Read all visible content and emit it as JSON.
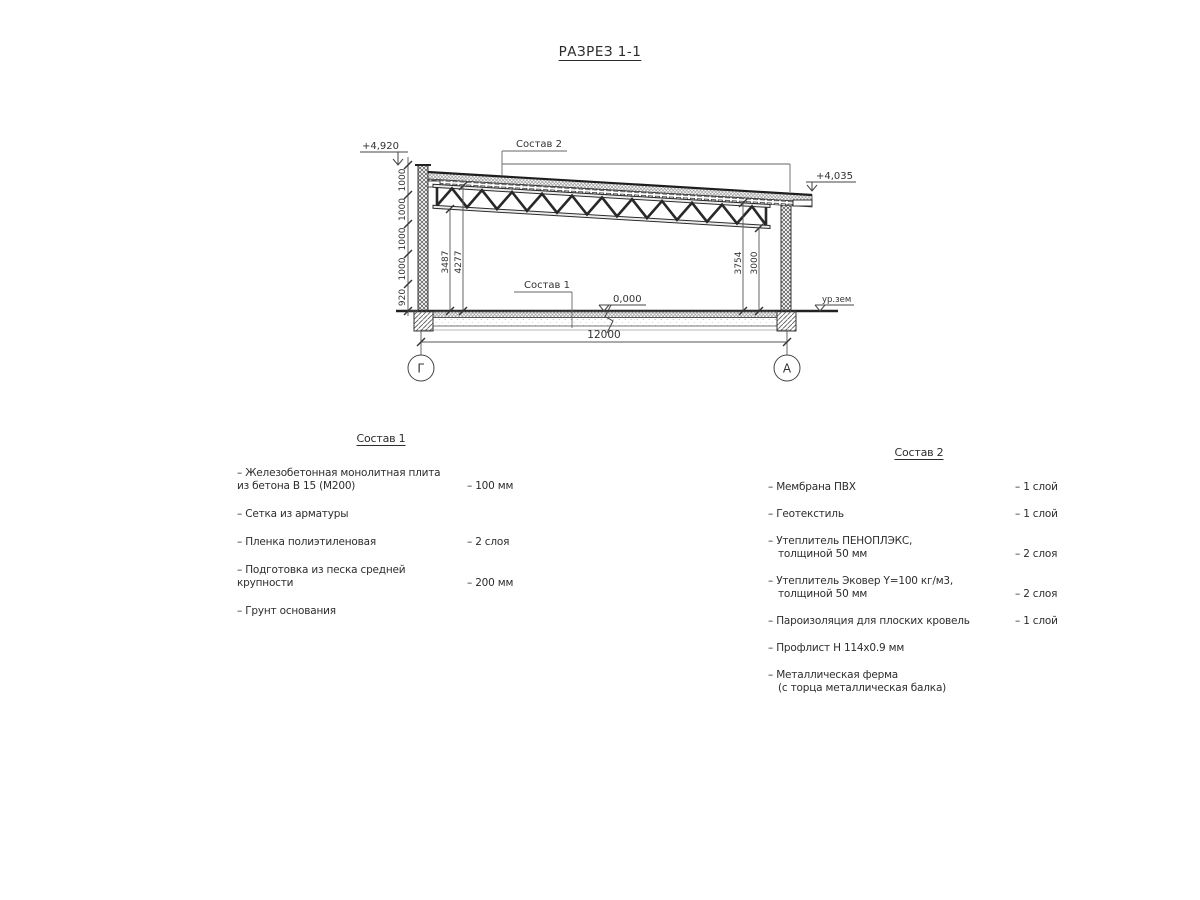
{
  "page_title": "РАЗРЕЗ 1-1",
  "drawing": {
    "elevations": {
      "parapet_top": "+4,920",
      "roof_right": "+4,035",
      "floor_zero": "0,000",
      "ground_level": "ур.зем"
    },
    "leaders": {
      "sostav1_label": "Состав 1",
      "sostav2_label": "Состав 2"
    },
    "dims": {
      "left_chain": [
        "1000",
        "1000",
        "1000",
        "1000",
        "920"
      ],
      "left_heights": [
        "3487",
        "4277"
      ],
      "right_heights": [
        "3754",
        "3000"
      ],
      "span": "12000"
    },
    "axes": {
      "left": "Г",
      "right": "А"
    }
  },
  "sostav1": {
    "title": "Состав 1",
    "items": [
      {
        "name": "– Железобетонная  монолитная плита",
        "name2": "из бетона В 15 (М200)",
        "value": "– 100 мм"
      },
      {
        "name": "– Сетка из арматуры"
      },
      {
        "name": "– Пленка полиэтиленовая",
        "value": "– 2 слоя"
      },
      {
        "name": "– Подготовка из песка средней крупности",
        "value": "– 200 мм"
      },
      {
        "name": "– Грунт основания"
      }
    ]
  },
  "sostav2": {
    "title": "Состав 2",
    "items": [
      {
        "name": "– Мембрана ПВХ",
        "value": "– 1 слой"
      },
      {
        "name": "– Геотекстиль",
        "value": "– 1 слой"
      },
      {
        "name": "– Утеплитель ПЕНОПЛЭКС,",
        "name2": "толщиной 50 мм",
        "value": "– 2 слоя"
      },
      {
        "name": "– Утеплитель Эковер Y=100 кг/м3,",
        "name2": "толщиной 50 мм",
        "value": "– 2 слоя"
      },
      {
        "name": "– Пароизоляция для плоских кровель",
        "value": "– 1 слой"
      },
      {
        "name": "– Профлист Н 114х0.9 мм"
      },
      {
        "name": "– Металлическая ферма",
        "name2": "(с торца металлическая балка)"
      }
    ]
  }
}
